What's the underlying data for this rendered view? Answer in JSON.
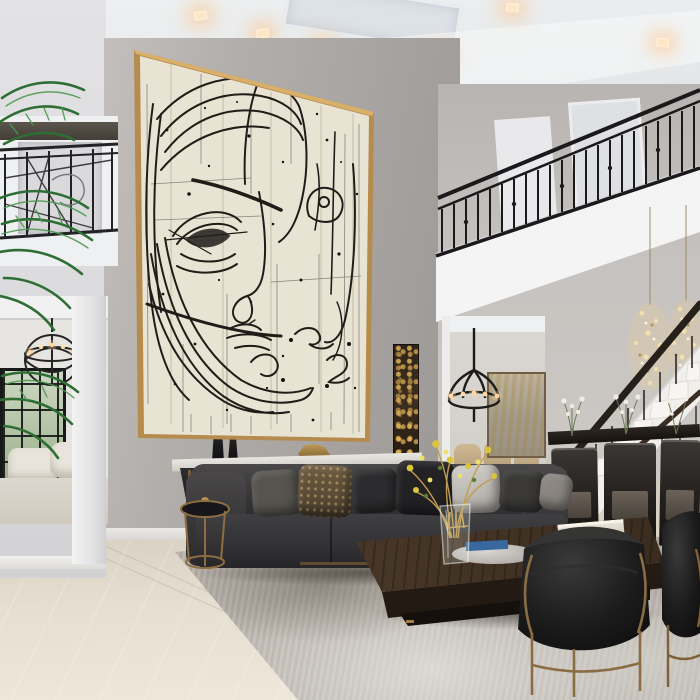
{
  "meta": {
    "type": "interior-photograph",
    "description": "Double-height luxury living room with an oversized beige abstract line-art face painting in a thin gold frame, charcoal sectional sofa, large dark wood coffee table, black velvet barrel chairs, wrought-iron balcony railings, staircase and dining nook",
    "width_px": 700,
    "height_px": 700
  },
  "palette": {
    "ceiling": "#eceeef",
    "wall_gray": "#aba7a4",
    "wall_light": "#dcdcde",
    "painting_canvas": "#e9e3d4",
    "painting_ink": "#201d19",
    "painting_frame_gold": "#b58c4e",
    "railing_iron": "#1b1a1c",
    "sofa_charcoal": "#38373a",
    "coffee_table_wood": "#4c3a2a",
    "rug_gray": "#a39c94",
    "floor_marble": "#e3dbcd",
    "bronze_metal": "#8a6a41",
    "palm_green": "#3a7c40",
    "recessed_light_warm": "#ffe7c6",
    "flower_yellow": "#d9c53b",
    "gold_leaf_art": "#caa14f"
  },
  "scene": {
    "artwork": {
      "style": "abstract continuous-line double face drawing on distressed beige canvas",
      "frame": "thin gold float frame",
      "orientation": "oversized vertical, two stories tall"
    },
    "objects": [
      {
        "name": "line-art-painting",
        "label": "Oversized abstract face painting"
      },
      {
        "name": "recessed-ceiling-lights",
        "label": "Warm square recessed downlights",
        "count": 7
      },
      {
        "name": "left-balcony-railing",
        "label": "Decorative iron mezzanine railing"
      },
      {
        "name": "right-balcony-railing",
        "label": "Black wrought-iron balcony railing with balusters"
      },
      {
        "name": "palm-plant",
        "label": "Tall indoor palm fronds"
      },
      {
        "name": "hallway-chandelier",
        "label": "Round iron candle chandelier"
      },
      {
        "name": "french-doors",
        "label": "Black-framed glass doors to garden"
      },
      {
        "name": "dining-chandelier",
        "label": "Black candelabra pendant"
      },
      {
        "name": "crystal-chandeliers",
        "label": "Pair of gold crystal stair pendants"
      },
      {
        "name": "staircase",
        "label": "White staircase with dark handrail"
      },
      {
        "name": "dining-chairs-beige",
        "label": "Beige upholstered dining chairs"
      },
      {
        "name": "bar-stools-dark",
        "label": "Dark wood open-back chairs",
        "count": 3
      },
      {
        "name": "gold-leaf-wall-art",
        "label": "Narrow vertical gold-leaf artwork"
      },
      {
        "name": "dining-room-art",
        "label": "Large muted gold abstract canvas"
      },
      {
        "name": "console-table",
        "label": "Angular black console with stone top and black vases"
      },
      {
        "name": "sectional-sofa",
        "label": "Charcoal velvet sectional with mixed pillows"
      },
      {
        "name": "coffee-table",
        "label": "Monolithic dark walnut coffee table"
      },
      {
        "name": "side-table-gold",
        "label": "Round bronze drink table"
      },
      {
        "name": "barrel-chairs",
        "label": "Black velvet barrel chairs with bronze frames",
        "count": 2
      },
      {
        "name": "area-rug",
        "label": "Distressed silver-gray area rug"
      },
      {
        "name": "marble-floor",
        "label": "Polished cream marble floor"
      },
      {
        "name": "flower-vase",
        "label": "Glass vase with yellow flowers and gold twigs"
      },
      {
        "name": "books-stack",
        "label": "Stack of white books"
      },
      {
        "name": "silver-tray",
        "label": "Round silver tray with blue book"
      }
    ]
  }
}
